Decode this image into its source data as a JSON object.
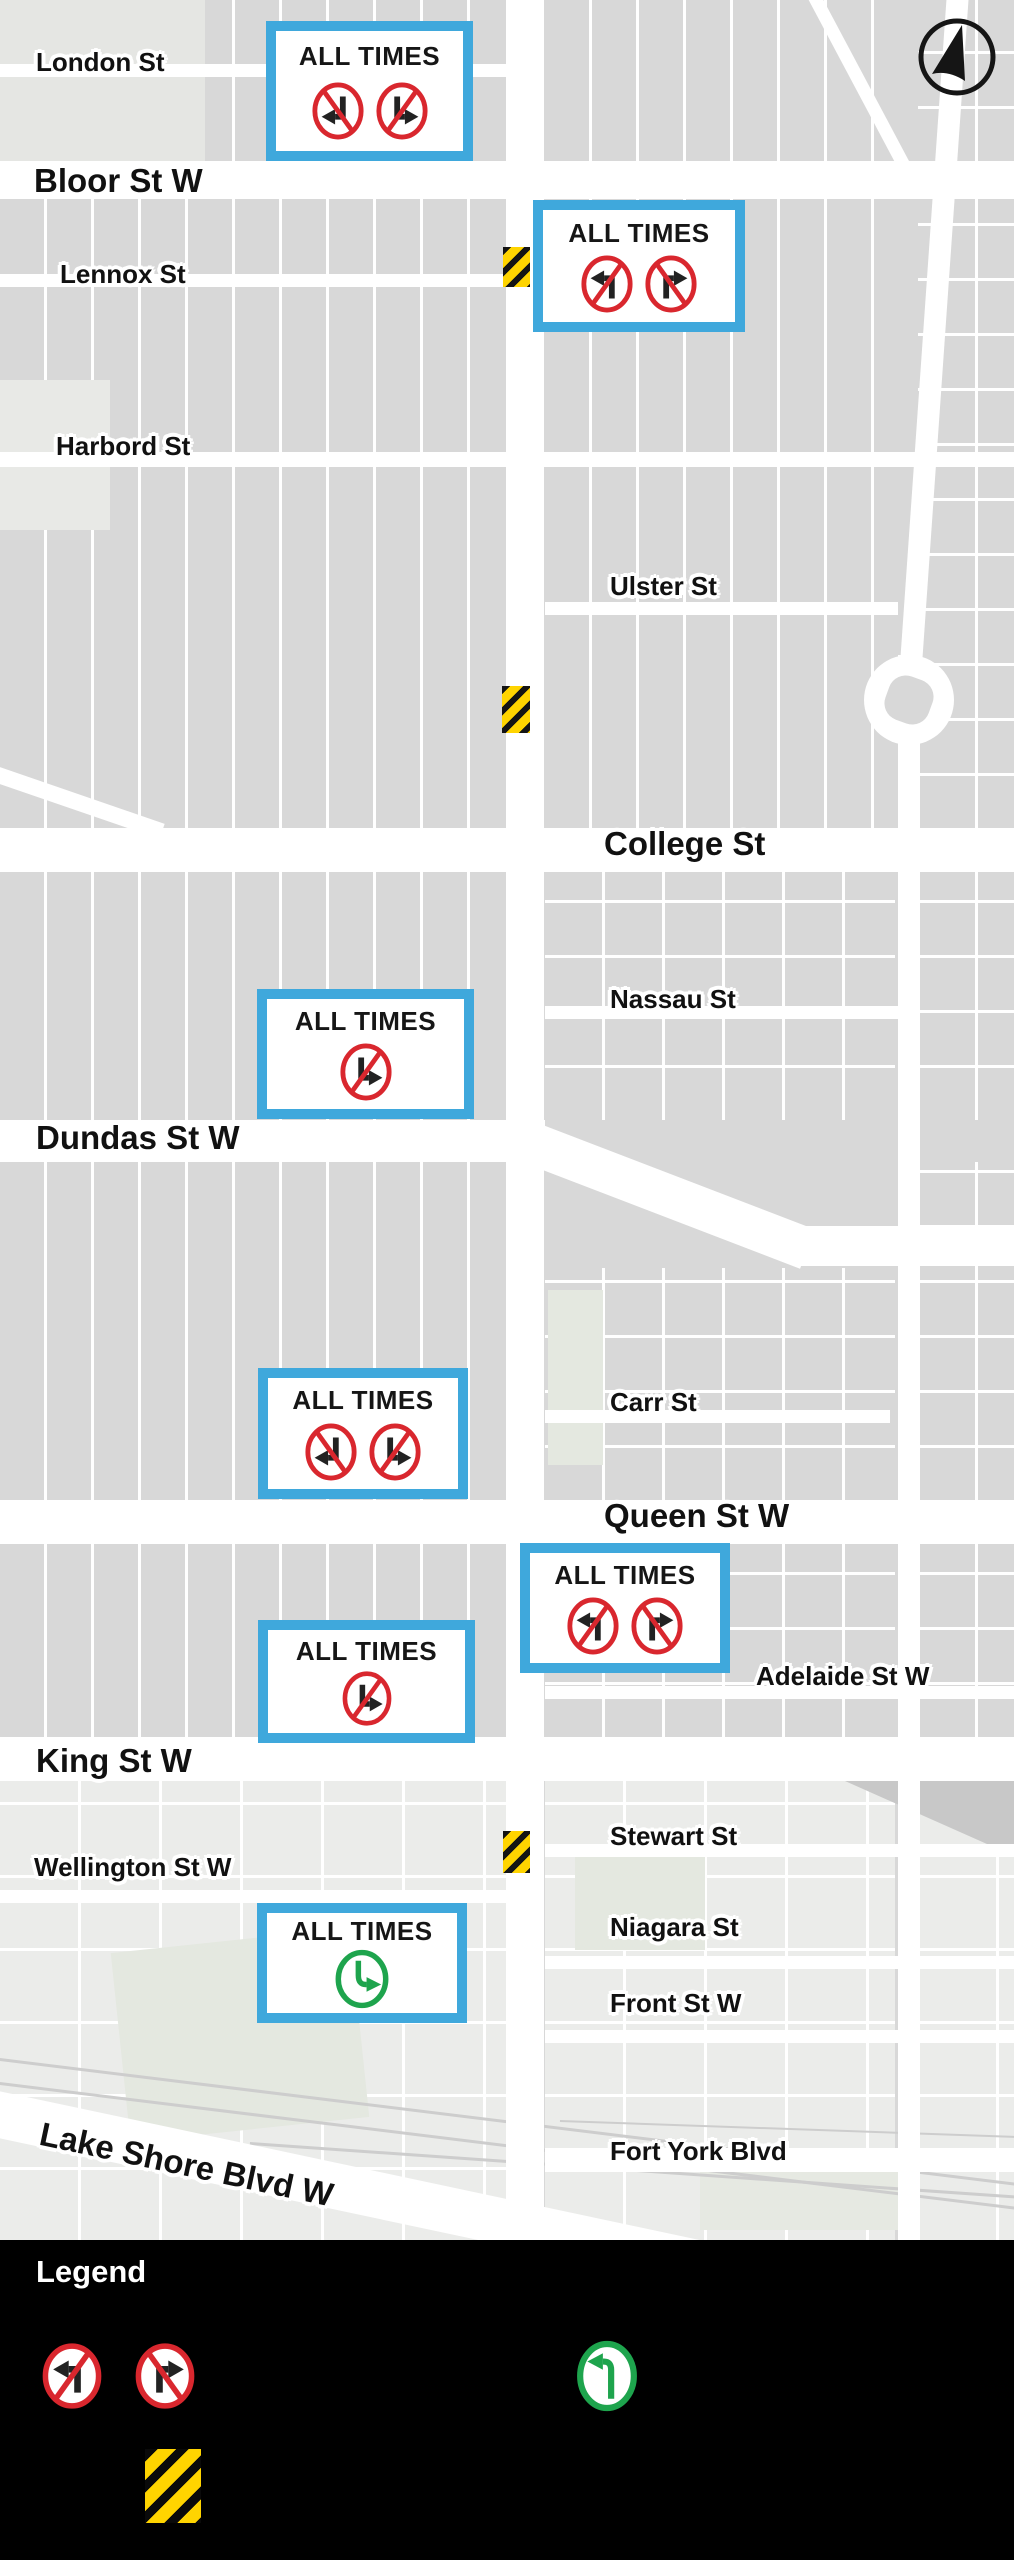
{
  "colors": {
    "sign_border_blue": "#3FA8DC",
    "prohibition_red": "#D9272E",
    "permitted_green": "#1EA44D",
    "hazard_yellow": "#FFD400",
    "map_block_gray": "#D8D8D8",
    "road_white": "#FFFFFF",
    "legend_black": "#000000",
    "label_ink": "#111111"
  },
  "streets": [
    {
      "name": "London St"
    },
    {
      "name": "Bloor St W"
    },
    {
      "name": "Lennox St"
    },
    {
      "name": "Harbord St"
    },
    {
      "name": "Ulster St"
    },
    {
      "name": "College St"
    },
    {
      "name": "Nassau St"
    },
    {
      "name": "Dundas St W"
    },
    {
      "name": "Carr St"
    },
    {
      "name": "Queen St W"
    },
    {
      "name": "Adelaide St W"
    },
    {
      "name": "King St W"
    },
    {
      "name": "Wellington St W"
    },
    {
      "name": "Stewart St"
    },
    {
      "name": "Niagara St"
    },
    {
      "name": "Front St W"
    },
    {
      "name": "Lake Shore Blvd W"
    },
    {
      "name": "Fort York Blvd"
    }
  ],
  "signs": [
    {
      "label": "ALL TIMES",
      "icons": [
        "no-left-turn-down",
        "no-right-turn-down"
      ]
    },
    {
      "label": "ALL TIMES",
      "icons": [
        "no-left-turn",
        "no-right-turn"
      ]
    },
    {
      "label": "ALL TIMES",
      "icons": [
        "no-right-turn-down"
      ]
    },
    {
      "label": "ALL TIMES",
      "icons": [
        "no-left-turn-down",
        "no-right-turn-down"
      ]
    },
    {
      "label": "ALL TIMES",
      "icons": [
        "no-left-turn",
        "no-right-turn"
      ]
    },
    {
      "label": "ALL TIMES",
      "icons": [
        "no-right-turn-down"
      ]
    },
    {
      "label": "ALL TIMES",
      "icons": [
        "left-turn-permitted-down"
      ]
    }
  ],
  "legend": {
    "title": "Legend",
    "items": [
      "no-left-turn",
      "no-right-turn",
      "left-turn-permitted",
      "construction-zone"
    ]
  },
  "compass": {
    "type": "north-arrow"
  }
}
